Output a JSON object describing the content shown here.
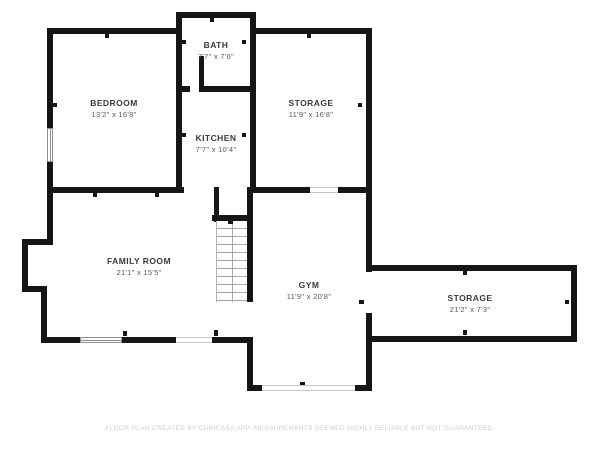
{
  "floor_plan": {
    "rooms": [
      {
        "name": "BATH",
        "dims": "7'7\" x 7'6\""
      },
      {
        "name": "BEDROOM",
        "dims": "13'2\" x 16'8\""
      },
      {
        "name": "STORAGE",
        "dims": "11'9\" x 16'8\""
      },
      {
        "name": "KITCHEN",
        "dims": "7'7\" x 10'4\""
      },
      {
        "name": "FAMILY ROOM",
        "dims": "21'1\" x 15'5\""
      },
      {
        "name": "GYM",
        "dims": "11'9\" x 20'8\""
      },
      {
        "name": "STORAGE",
        "dims": "21'2\" x 7'3\""
      }
    ],
    "footer": "FLOOR PLAN CREATED BY CUBICASA APP. MEASUREMENTS DEEMED HIGHLY RELIABLE BUT NOT GUARANTEED.",
    "colors": {
      "wall": "#161616",
      "room_name": "#3a3a3a",
      "room_dims": "#5a5a5a",
      "footer_text": "#cfcfcf",
      "stair_tread": "#a6a6a6",
      "window_outline": "#8f8f8f",
      "background": "#ffffff"
    }
  }
}
